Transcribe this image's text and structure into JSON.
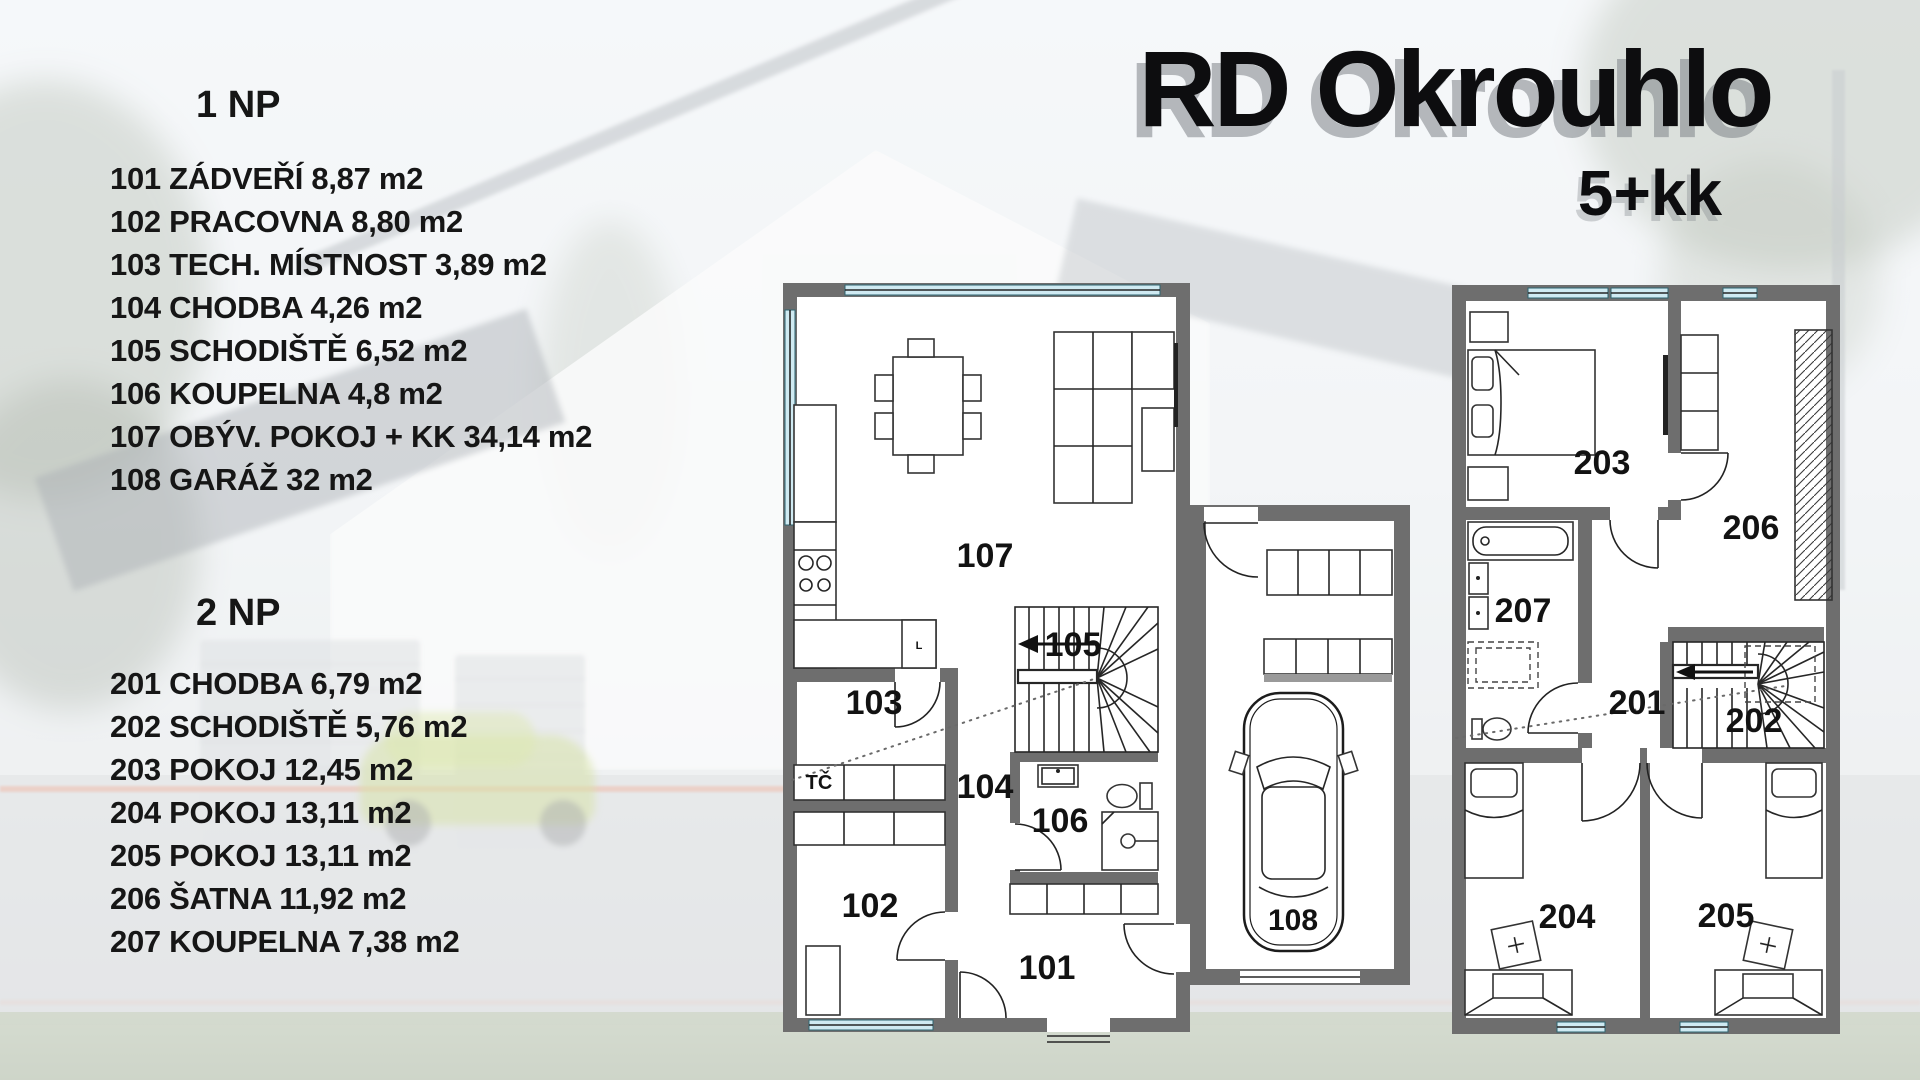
{
  "title": {
    "main": "RD Okrouhlo",
    "subtitle": "5+kk"
  },
  "floors": [
    {
      "heading": "1 NP",
      "items": [
        "101 ZÁDVEŘÍ 8,87 m2",
        "102 PRACOVNA 8,80 m2",
        "103 TECH. MÍSTNOST 3,89 m2",
        "104 CHODBA 4,26 m2",
        "105 SCHODIŠTĚ 6,52 m2",
        "106 KOUPELNA 4,8 m2",
        "107 OBÝV. POKOJ + KK 34,14 m2",
        "108 GARÁŽ 32 m2"
      ]
    },
    {
      "heading": "2 NP",
      "items": [
        "201 CHODBA 6,79 m2",
        "202 SCHODIŠTĚ 5,76 m2",
        "203 POKOJ 12,45 m2",
        "204 POKOJ 13,11 m2",
        "205 POKOJ 13,11 m2",
        "206 ŠATNA 11,92 m2",
        "207 KOUPELNA 7,38 m2"
      ]
    }
  ],
  "plan1": {
    "labels": {
      "r101": "101",
      "r102": "102",
      "r103": "103",
      "r104": "104",
      "r105": "105",
      "r106": "106",
      "r107": "107",
      "r108": "108",
      "tc": "TČ",
      "sink": "L"
    }
  },
  "plan2": {
    "labels": {
      "r201": "201",
      "r202": "202",
      "r203": "203",
      "r204": "204",
      "r205": "205",
      "r206": "206",
      "r207": "207"
    }
  },
  "colors": {
    "wall": "#6e6e6e",
    "window_glass": "#cfeaf2",
    "text": "#161616",
    "title_shadow": "#7d8389"
  }
}
